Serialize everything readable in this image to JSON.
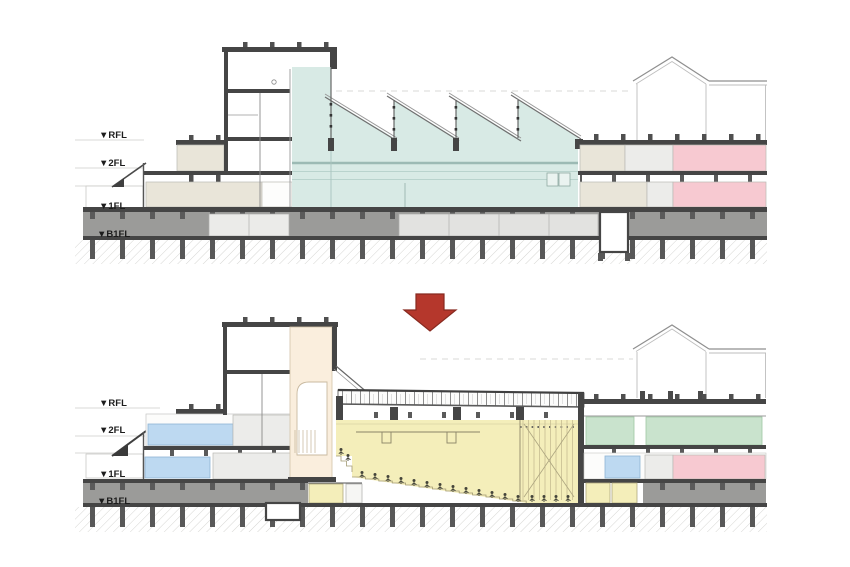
{
  "sections": [
    {
      "name": "section-before",
      "levels": [
        "▼RFL",
        "▼2FL",
        "▼1FL",
        "▼B1FL"
      ]
    },
    {
      "name": "section-after",
      "levels": [
        "▼RFL",
        "▼2FL",
        "▼1FL",
        "▼B1FL"
      ]
    }
  ],
  "arrow": {
    "icon": "down-block-arrow"
  },
  "colors": {
    "c-teal": "#d8eae5",
    "c-beige": "#e9e5d9",
    "c-lgray": "#ececea",
    "c-pink": "#f7c9d1",
    "c-green": "#c9e3cd",
    "c-blue": "#bdd9f1",
    "c-yellow": "#f4eeba",
    "c-cream": "#faeedd",
    "c-basement": "#9b9b99",
    "c-arrow": "#b5372c"
  }
}
